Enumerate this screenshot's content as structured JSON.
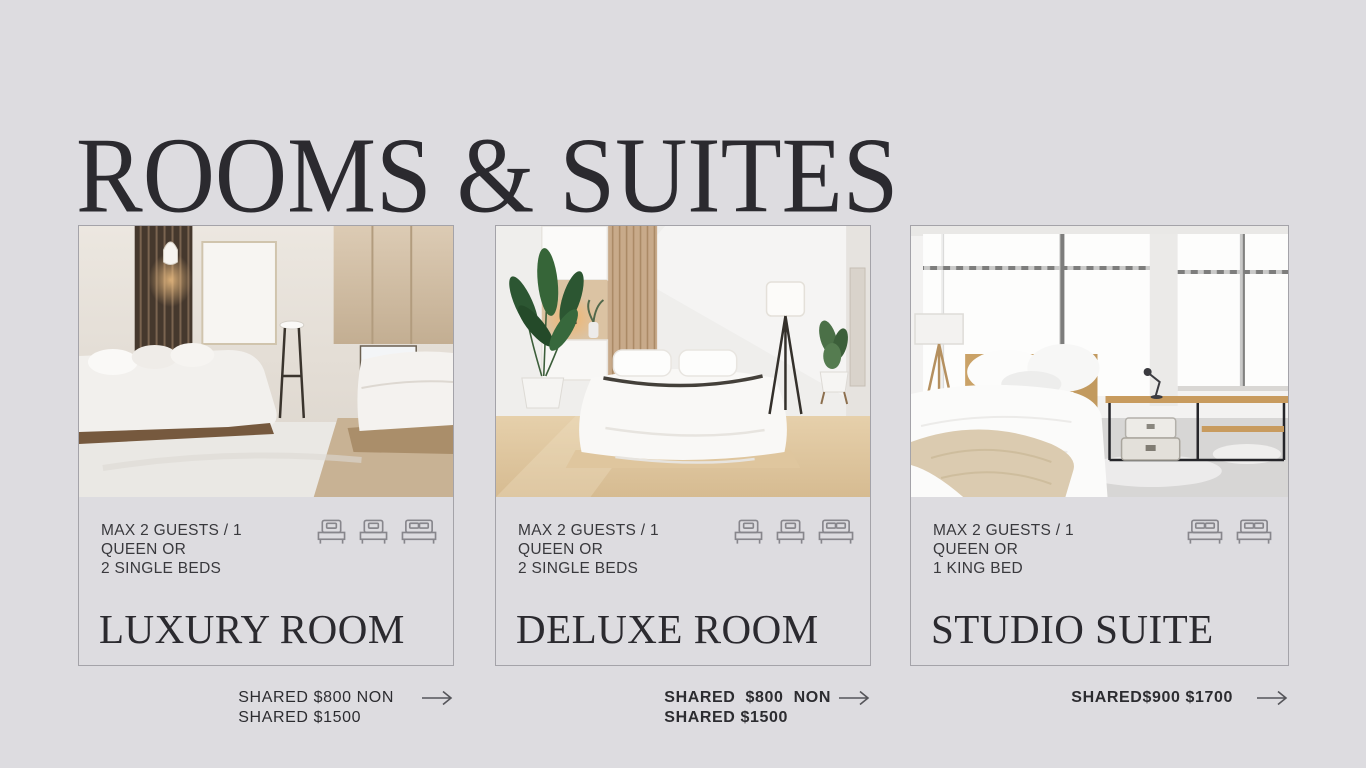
{
  "page": {
    "title": "ROOMS & SUITES",
    "background_color": "#dddce0",
    "heading_color": "#2b2a2f",
    "card_border_color": "#a4a3a9",
    "arrow_color": "#55555a"
  },
  "cards": [
    {
      "name": "LUXURY ROOM",
      "occupancy": [
        "MAX 2 GUESTS / 1",
        "QUEEN OR",
        "2 SINGLE BEDS"
      ],
      "bed_icons": [
        "single-bed-icon",
        "single-bed-icon",
        "double-bed-icon"
      ],
      "price_lines": [
        "SHARED $800 NON",
        "SHARED $1500"
      ]
    },
    {
      "name": "DELUXE ROOM",
      "occupancy": [
        "MAX 2 GUESTS / 1",
        "QUEEN OR",
        "2 SINGLE BEDS"
      ],
      "bed_icons": [
        "single-bed-icon",
        "single-bed-icon",
        "double-bed-icon"
      ],
      "price_lines": [
        "SHARED  $800  NON",
        "SHARED $1500"
      ]
    },
    {
      "name": "STUDIO SUITE",
      "occupancy": [
        "MAX 2 GUESTS / 1",
        "QUEEN OR",
        "1 KING BED"
      ],
      "bed_icons": [
        "double-bed-icon",
        "double-bed-icon"
      ],
      "price_lines": [
        "SHARED$900 $1700"
      ]
    }
  ]
}
